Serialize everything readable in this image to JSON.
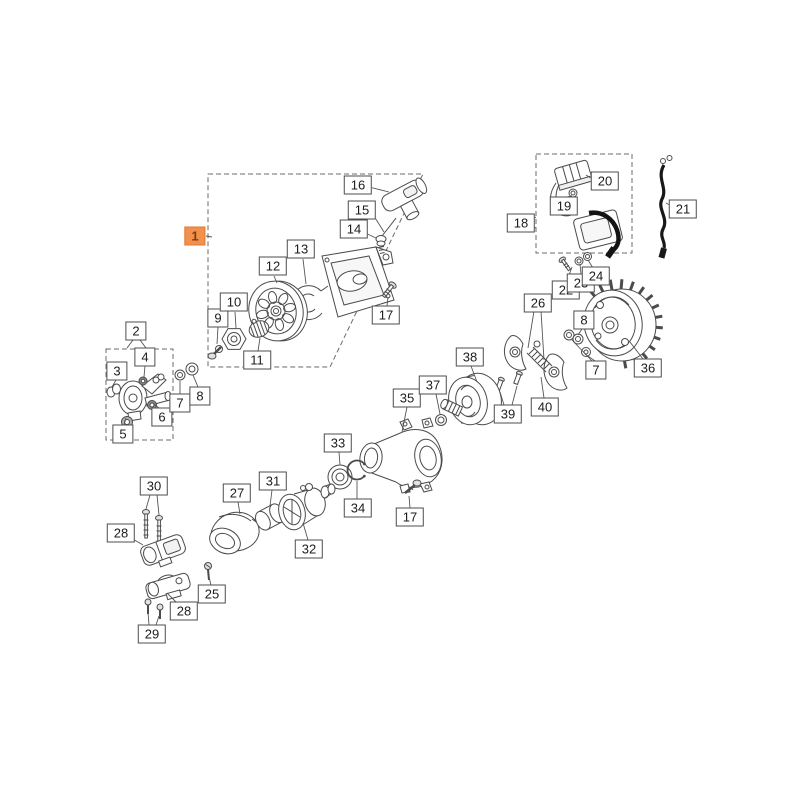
{
  "diagram": {
    "kind": "exploded-parts-diagram",
    "background_color": "#ffffff",
    "line_color": "#4b4b4b",
    "label_background": "#ffffff",
    "label_border_color": "#4d4d4d",
    "label_text_color": "#1c1c1c",
    "highlight_color": "#F2914D",
    "highlight_border_color": "#E07A28",
    "highlight_text_color": "#7E3A10"
  },
  "callouts": [
    {
      "id": "1",
      "label": "1",
      "x": 195,
      "y": 236,
      "highlight": true
    },
    {
      "id": "2",
      "label": "2",
      "x": 136,
      "y": 331
    },
    {
      "id": "3",
      "label": "3",
      "x": 117,
      "y": 371
    },
    {
      "id": "4",
      "label": "4",
      "x": 145,
      "y": 357
    },
    {
      "id": "5",
      "label": "5",
      "x": 123,
      "y": 434
    },
    {
      "id": "6",
      "label": "6",
      "x": 162,
      "y": 417
    },
    {
      "id": "7a",
      "label": "7",
      "x": 180,
      "y": 403
    },
    {
      "id": "8a",
      "label": "8",
      "x": 200,
      "y": 396
    },
    {
      "id": "9",
      "label": "9",
      "x": 218,
      "y": 318
    },
    {
      "id": "10",
      "label": "10",
      "x": 234,
      "y": 302
    },
    {
      "id": "11",
      "label": "11",
      "x": 257,
      "y": 360
    },
    {
      "id": "12",
      "label": "12",
      "x": 273,
      "y": 266
    },
    {
      "id": "13",
      "label": "13",
      "x": 301,
      "y": 249
    },
    {
      "id": "14",
      "label": "14",
      "x": 354,
      "y": 229
    },
    {
      "id": "15",
      "label": "15",
      "x": 362,
      "y": 210
    },
    {
      "id": "16",
      "label": "16",
      "x": 358,
      "y": 185
    },
    {
      "id": "17a",
      "label": "17",
      "x": 386,
      "y": 315
    },
    {
      "id": "17b",
      "label": "17",
      "x": 410,
      "y": 517
    },
    {
      "id": "18",
      "label": "18",
      "x": 521,
      "y": 223
    },
    {
      "id": "19",
      "label": "19",
      "x": 564,
      "y": 206
    },
    {
      "id": "20",
      "label": "20",
      "x": 605,
      "y": 181
    },
    {
      "id": "21",
      "label": "21",
      "x": 683,
      "y": 209
    },
    {
      "id": "22",
      "label": "22",
      "x": 566,
      "y": 290
    },
    {
      "id": "23",
      "label": "23",
      "x": 581,
      "y": 283
    },
    {
      "id": "24",
      "label": "24",
      "x": 596,
      "y": 276
    },
    {
      "id": "25",
      "label": "25",
      "x": 212,
      "y": 594
    },
    {
      "id": "26",
      "label": "26",
      "x": 538,
      "y": 303
    },
    {
      "id": "27",
      "label": "27",
      "x": 237,
      "y": 493
    },
    {
      "id": "28a",
      "label": "28",
      "x": 121,
      "y": 533
    },
    {
      "id": "28b",
      "label": "28",
      "x": 184,
      "y": 611
    },
    {
      "id": "29",
      "label": "29",
      "x": 152,
      "y": 634
    },
    {
      "id": "30",
      "label": "30",
      "x": 154,
      "y": 486
    },
    {
      "id": "31",
      "label": "31",
      "x": 273,
      "y": 481
    },
    {
      "id": "32",
      "label": "32",
      "x": 309,
      "y": 549
    },
    {
      "id": "33",
      "label": "33",
      "x": 338,
      "y": 443
    },
    {
      "id": "34",
      "label": "34",
      "x": 358,
      "y": 508
    },
    {
      "id": "35",
      "label": "35",
      "x": 407,
      "y": 398
    },
    {
      "id": "36",
      "label": "36",
      "x": 648,
      "y": 368
    },
    {
      "id": "37",
      "label": "37",
      "x": 433,
      "y": 385
    },
    {
      "id": "38",
      "label": "38",
      "x": 470,
      "y": 357
    },
    {
      "id": "39",
      "label": "39",
      "x": 508,
      "y": 414
    },
    {
      "id": "40",
      "label": "40",
      "x": 545,
      "y": 407
    },
    {
      "id": "7b",
      "label": "7",
      "x": 596,
      "y": 370
    },
    {
      "id": "8b",
      "label": "8",
      "x": 584,
      "y": 320
    }
  ]
}
